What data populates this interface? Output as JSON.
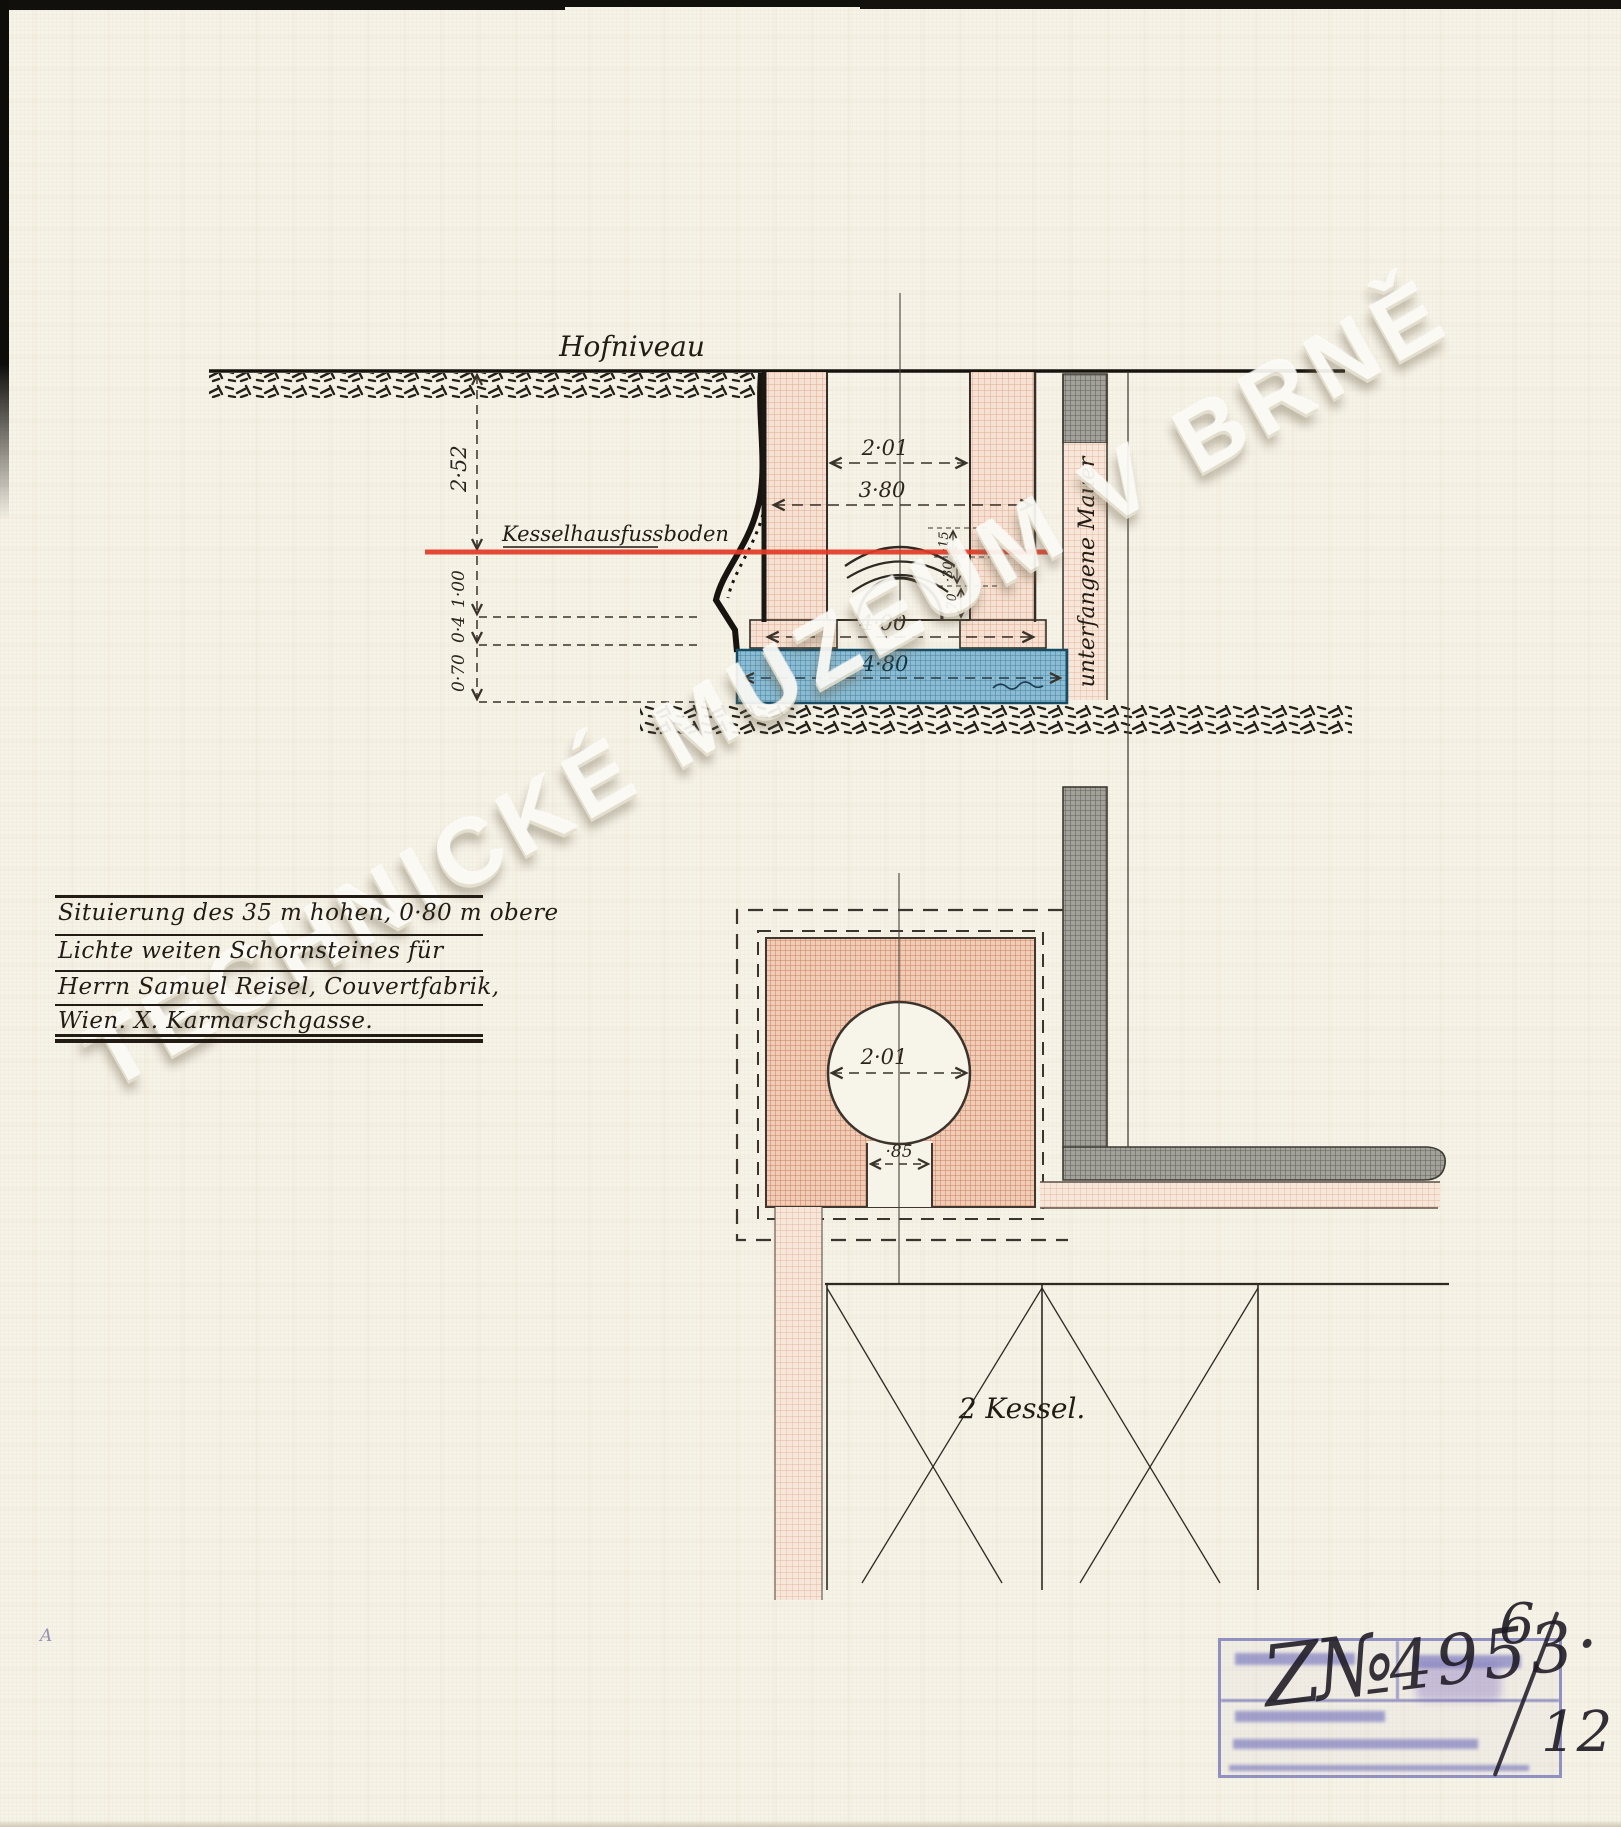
{
  "watermark": "TECHNICKÉ MUZEUM V BRNĚ",
  "labels": {
    "hofniveau": "Hofniveau",
    "kesselhausfussboden": "Kesselhausfussboden",
    "wall_label": "unterfangene Mauer",
    "kessel": "2 Kessel."
  },
  "title_block": {
    "lines": [
      "Situierung des 35 m hohen, 0·80 m obere",
      "Lichte weiten Schornsteines für",
      "Herrn Samuel Reisel, Couvertfabrik,",
      "Wien. X. Karmarschgasse."
    ]
  },
  "dimensions": {
    "section": {
      "ground_to_floor": "2·52",
      "seg1": "1·00",
      "seg2": "0·4",
      "seg3": "0·70",
      "inner_width": "2·01",
      "outer_width": "3·80",
      "base_width": "4·00",
      "foundation_width": "4·80",
      "arch_top": "·15",
      "arch_mid": "·30",
      "arch_bottom": "·70"
    },
    "plan": {
      "flue_diameter": "2·01",
      "channel_width": "·85"
    }
  },
  "stamp": {
    "prefix": "Z№",
    "number": "4953·",
    "fraction_top": "6",
    "fraction_bottom": "12"
  },
  "margin_note": "A",
  "colors": {
    "paper": "#f6f3e9",
    "masonry_pink": "#eec9b2",
    "wall_gray": "#a3a29a",
    "concrete_blue": "#8cbcd3",
    "level_red": "#e33b27",
    "stamp_blue": "#5858ac",
    "ink": "#2e2922"
  }
}
